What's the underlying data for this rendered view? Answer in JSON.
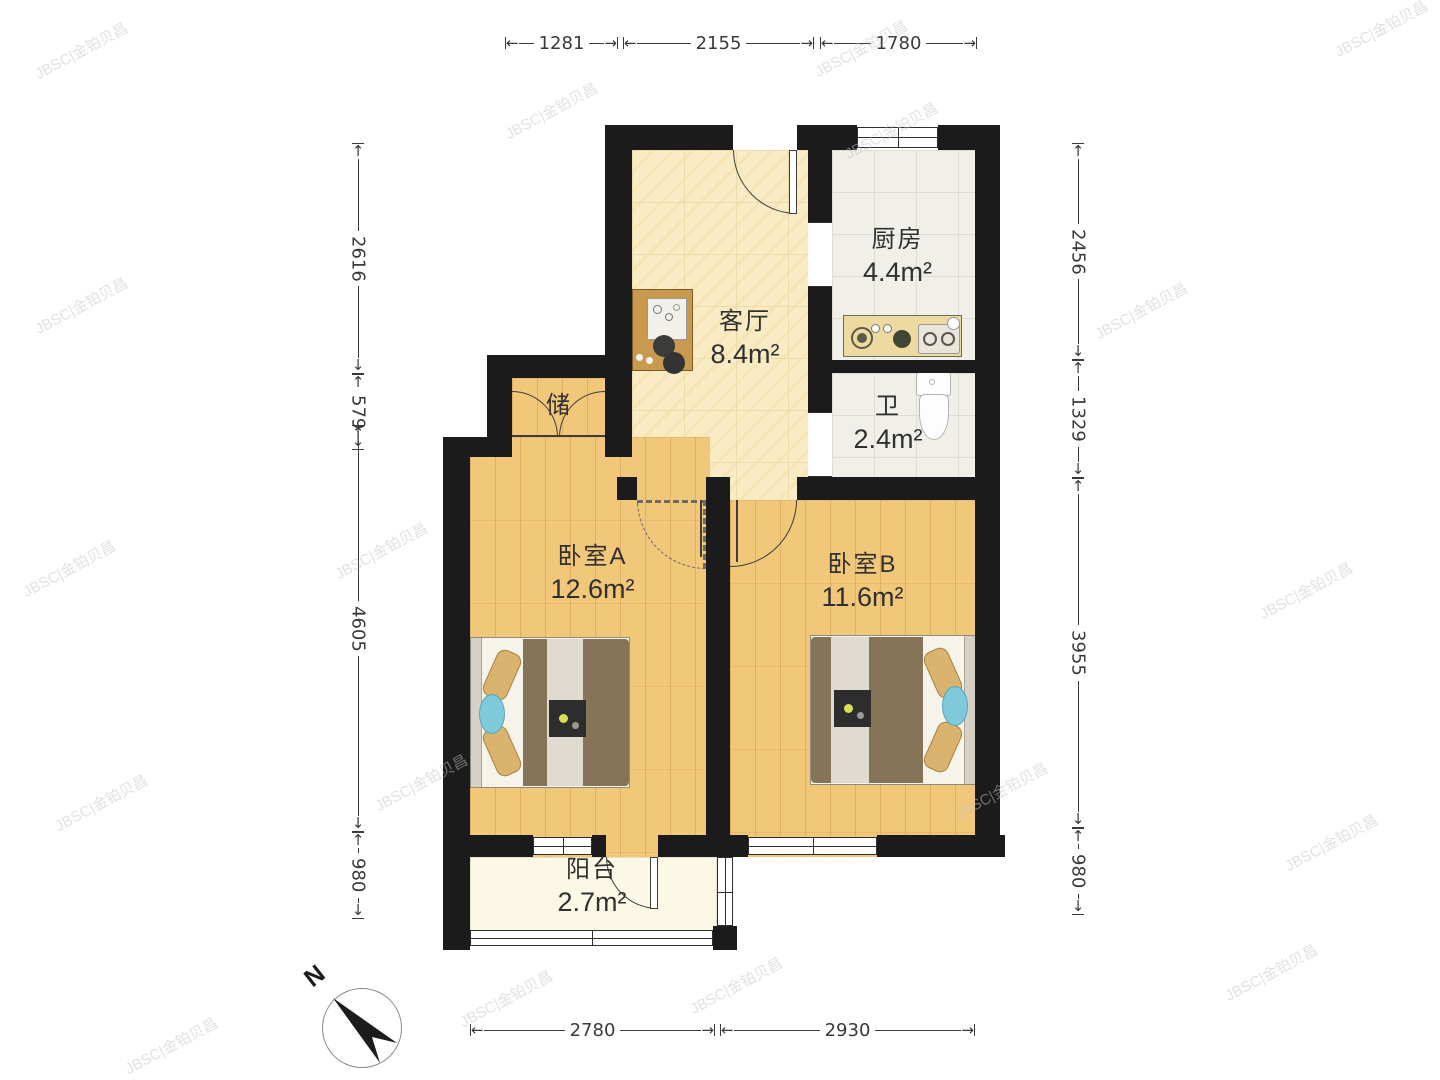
{
  "rooms": {
    "living": {
      "name": "客厅",
      "area": "8.4m²"
    },
    "kitchen": {
      "name": "厨房",
      "area": "4.4m²"
    },
    "bath": {
      "name": "卫",
      "area": "2.4m²"
    },
    "storage": {
      "name": "储"
    },
    "bedroomA": {
      "name": "卧室A",
      "area": "12.6m²"
    },
    "bedroomB": {
      "name": "卧室B",
      "area": "11.6m²"
    },
    "balcony": {
      "name": "阳台",
      "area": "2.7m²"
    }
  },
  "dimensions": {
    "top": [
      {
        "label": "1281",
        "x": 505,
        "len": 113
      },
      {
        "label": "2155",
        "x": 623,
        "len": 191
      },
      {
        "label": "1780",
        "x": 820,
        "len": 157
      }
    ],
    "bottom": [
      {
        "label": "2780",
        "x": 470,
        "len": 245
      },
      {
        "label": "2930",
        "x": 720,
        "len": 255
      }
    ],
    "left": [
      {
        "label": "2616",
        "y": 143,
        "len": 231
      },
      {
        "label": "579",
        "y": 374,
        "len": 51
      },
      {
        "label": "4605",
        "y": 425,
        "len": 407
      },
      {
        "label": "980",
        "y": 832,
        "len": 87
      }
    ],
    "right": [
      {
        "label": "2456",
        "y": 143,
        "len": 217
      },
      {
        "label": "1329",
        "y": 360,
        "len": 118
      },
      {
        "label": "3955",
        "y": 478,
        "len": 350
      },
      {
        "label": "980",
        "y": 828,
        "len": 87
      }
    ]
  },
  "compass": {
    "label": "N"
  },
  "watermark": {
    "text": "JBSC|金铂贝昌"
  },
  "colors": {
    "wall": "#1b1b1b",
    "wood": "#f1c77a",
    "marble": "#f9ecc5",
    "tile": "#f1efe9",
    "accent_cyan": "#7ec9da",
    "blanket": "#867459"
  }
}
